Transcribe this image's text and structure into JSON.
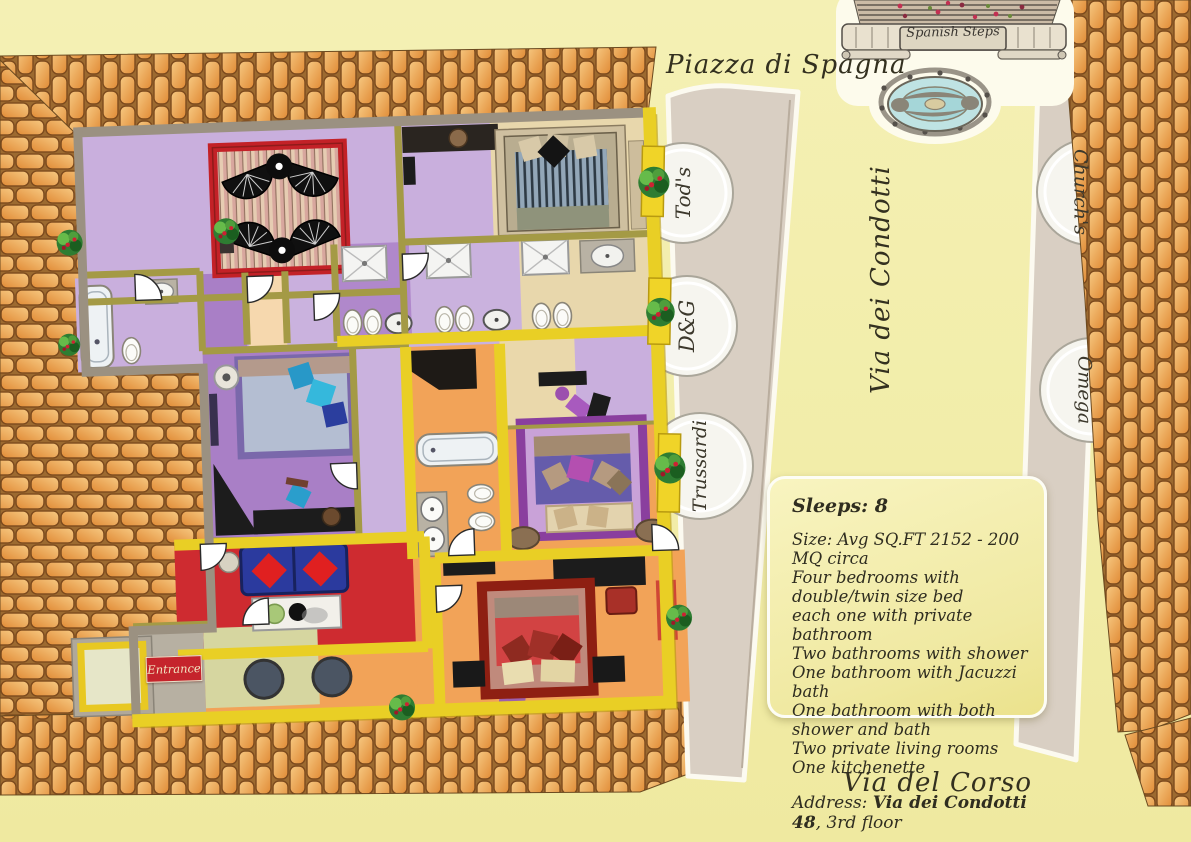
{
  "labels": {
    "piazza": "Piazza di Spagna",
    "condotti": "Via dei Condotti",
    "corso": "Via del Corso",
    "spanish_steps": "Spanish Steps",
    "entrance": "Entrance"
  },
  "shops": {
    "tods": "Tod's",
    "dg": "D&G",
    "trussardi": "Trussardi",
    "churchs": "Church's",
    "omega": "Omega"
  },
  "info_box": {
    "sleeps": "Sleeps: 8",
    "lines": [
      "Size: Avg SQ.FT 2152 - 200 MQ circa",
      "Four bedrooms with double/twin size bed",
      "each one with private bathroom",
      "Two bathrooms with shower",
      "One bathroom with Jacuzzi bath",
      "One bathroom with both shower and bath",
      "Two private living rooms",
      "One kitchenette"
    ],
    "address_label": "Address: ",
    "address_bold": "Via dei Condotti 48",
    "address_rest": ", 3rd floor"
  },
  "colors": {
    "background": "#f2eda9",
    "brick": "#efa954",
    "brick_outline": "#7c4a1d",
    "street": "#d9cfc3",
    "wall_yellow": "#e9cf25",
    "wall_olive": "#a49a45",
    "plan_border": "#9b9181",
    "lavender_floor": "#c9afdd",
    "purple_floor": "#a97fc6",
    "orange_floor": "#f2a358",
    "tan_floor": "#e8d7ac",
    "red_room": "#ce2b30",
    "terrace_frame": "#c32127",
    "info_text": "#2f2d20"
  }
}
